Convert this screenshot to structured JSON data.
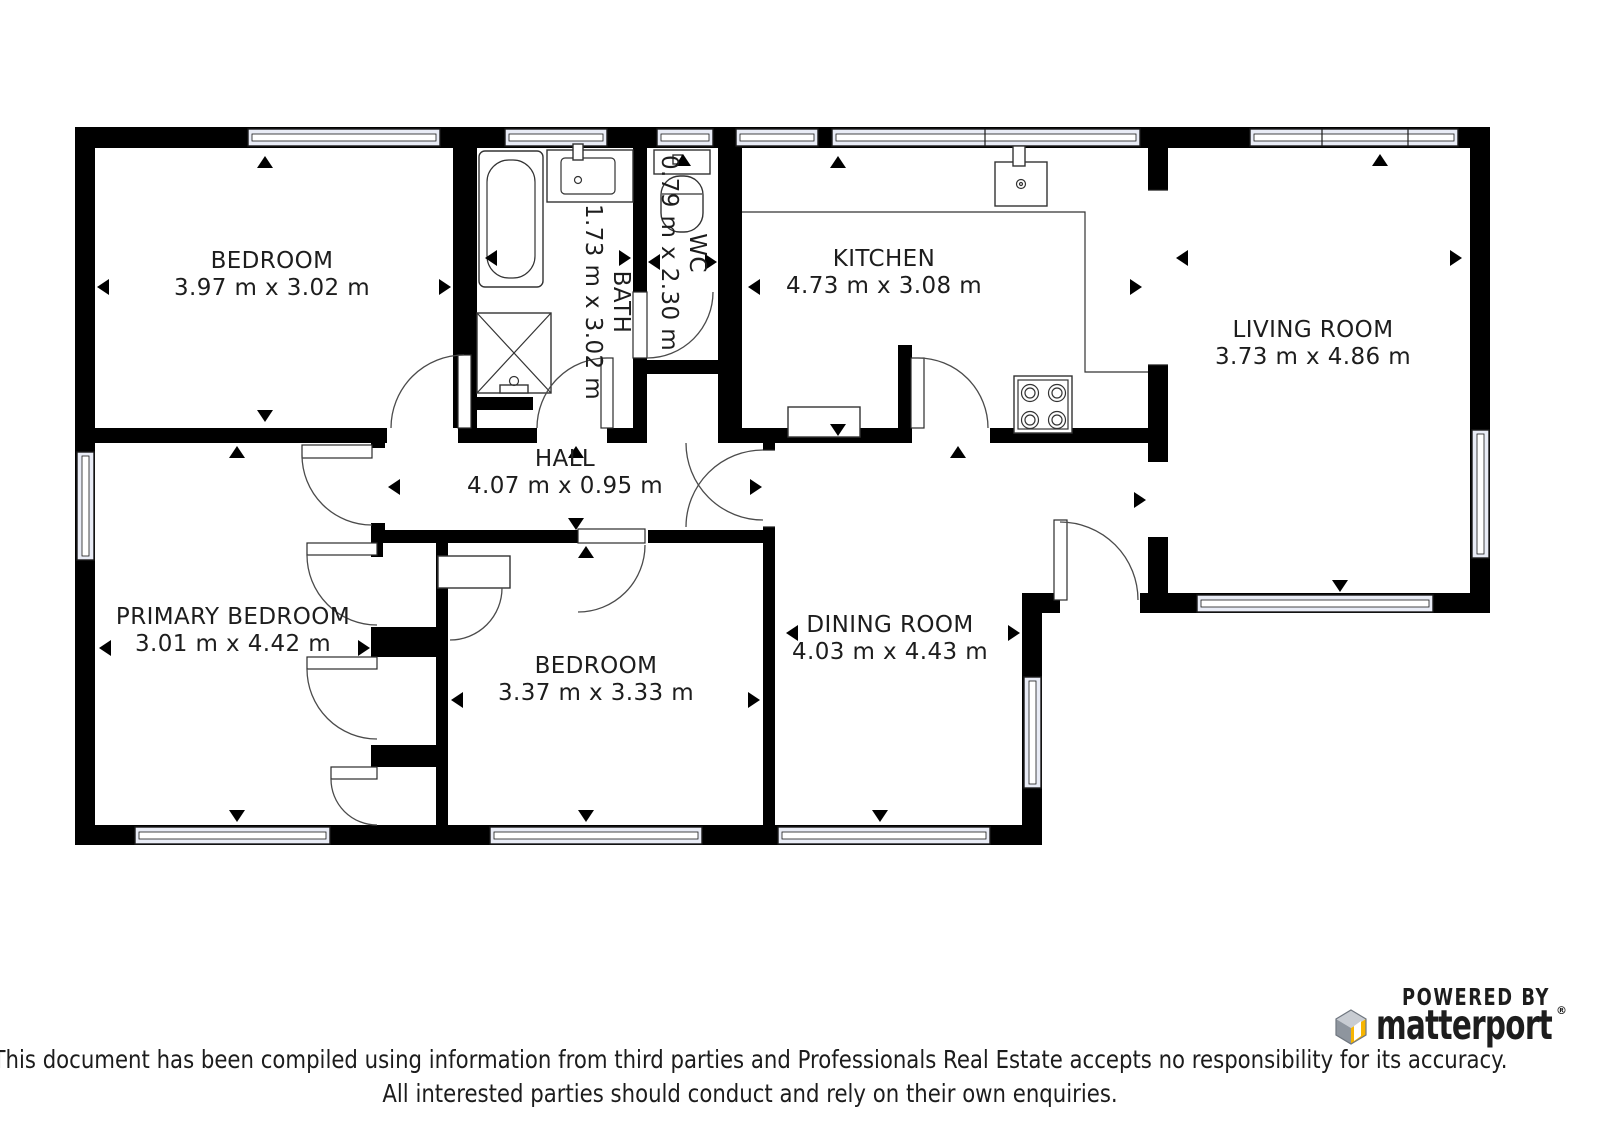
{
  "rooms": [
    {
      "id": "bedroom-1",
      "name": "BEDROOM",
      "dims": "3.97 m x 3.02 m"
    },
    {
      "id": "bath",
      "name": "BATH",
      "dims": "1.73 m x 3.02 m"
    },
    {
      "id": "wc",
      "name": "WC",
      "dims": "0.79 m x 2.30 m"
    },
    {
      "id": "kitchen",
      "name": "KITCHEN",
      "dims": "4.73 m x 3.08 m"
    },
    {
      "id": "living-room",
      "name": "LIVING ROOM",
      "dims": "3.73 m x 4.86 m"
    },
    {
      "id": "hall",
      "name": "HALL",
      "dims": "4.07 m x 0.95 m"
    },
    {
      "id": "primary-bedroom",
      "name": "PRIMARY BEDROOM",
      "dims": "3.01 m x 4.42 m"
    },
    {
      "id": "bedroom-2",
      "name": "BEDROOM",
      "dims": "3.37 m x 3.33 m"
    },
    {
      "id": "dining-room",
      "name": "DINING ROOM",
      "dims": "4.03 m x 4.43 m"
    }
  ],
  "branding": {
    "powered_by": "POWERED BY",
    "logo_text": "matterport",
    "registered_mark": "®"
  },
  "disclaimer": {
    "line1": "This document has been compiled using information from third parties and Professionals Real Estate accepts no responsibility for its accuracy.",
    "line2": "All interested parties should conduct and rely on their own enquiries."
  },
  "colors": {
    "wall": "#000000",
    "window_fill": "#e9ecf6",
    "brand_navy": "#1b3a5f",
    "logo_yellow": "#f7b500",
    "logo_gray": "#8e959e",
    "logo_gray_light": "#c8ccd2"
  }
}
